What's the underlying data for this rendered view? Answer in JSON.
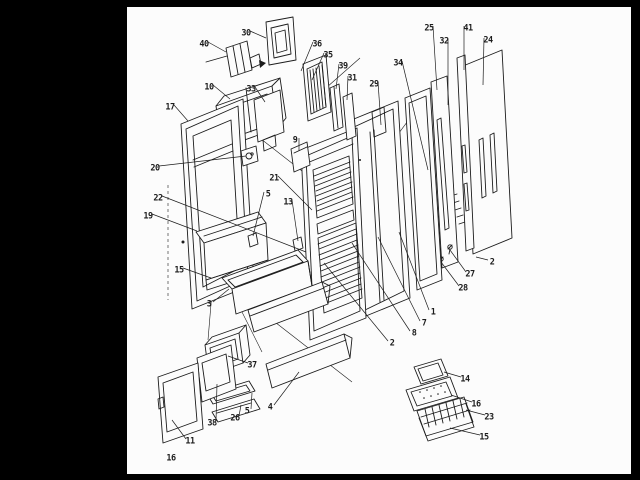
{
  "page": {
    "number": "16"
  },
  "colors": {
    "ink": "#1c1c1c",
    "paper": "#fcfcfc",
    "border": "#000000"
  },
  "figure": {
    "description": "Exploded parts diagram of a refrigerator door assembly",
    "callouts": [
      {
        "label": "40",
        "x": 204,
        "y": 44,
        "tx": 226,
        "ty": 52
      },
      {
        "label": "30",
        "x": 246,
        "y": 33,
        "tx": 266,
        "ty": 38
      },
      {
        "label": "36",
        "x": 317,
        "y": 44,
        "tx": 301,
        "ty": 71
      },
      {
        "label": "35",
        "x": 328,
        "y": 55,
        "tx": 312,
        "ty": 80
      },
      {
        "label": "39",
        "x": 343,
        "y": 66,
        "tx": 336,
        "ty": 89
      },
      {
        "label": "31",
        "x": 352,
        "y": 78,
        "tx": 347,
        "ty": 100
      },
      {
        "label": "34",
        "x": 398,
        "y": 63,
        "tx": 428,
        "ty": 170
      },
      {
        "label": "29",
        "x": 374,
        "y": 84,
        "tx": 381,
        "ty": 125
      },
      {
        "label": "25",
        "x": 429,
        "y": 28,
        "tx": 437,
        "ty": 90
      },
      {
        "label": "32",
        "x": 444,
        "y": 41,
        "tx": 448,
        "ty": 105
      },
      {
        "label": "41",
        "x": 468,
        "y": 28,
        "tx": 464,
        "ty": 70
      },
      {
        "label": "24",
        "x": 488,
        "y": 40,
        "tx": 483,
        "ty": 85
      },
      {
        "label": "10",
        "x": 209,
        "y": 87,
        "tx": 230,
        "ty": 99
      },
      {
        "label": "33",
        "x": 251,
        "y": 89,
        "tx": 265,
        "ty": 102
      },
      {
        "label": "17",
        "x": 170,
        "y": 107,
        "tx": 188,
        "ty": 121
      },
      {
        "label": "9",
        "x": 295,
        "y": 140,
        "tx": 299,
        "ty": 151
      },
      {
        "label": "20",
        "x": 155,
        "y": 168,
        "tx": 246,
        "ty": 156
      },
      {
        "label": "21",
        "x": 274,
        "y": 178,
        "tx": 312,
        "ty": 210
      },
      {
        "label": "22",
        "x": 158,
        "y": 198,
        "tx": 306,
        "ty": 252
      },
      {
        "label": "5",
        "x": 268,
        "y": 194,
        "tx": 253,
        "ty": 236
      },
      {
        "label": "13",
        "x": 288,
        "y": 202,
        "tx": 298,
        "ty": 241
      },
      {
        "label": "19",
        "x": 148,
        "y": 216,
        "tx": 197,
        "ty": 231
      },
      {
        "label": "15",
        "x": 179,
        "y": 270,
        "tx": 211,
        "ty": 278
      },
      {
        "label": "3",
        "x": 209,
        "y": 304,
        "tx": 229,
        "ty": 289
      },
      {
        "label": "37",
        "x": 252,
        "y": 365,
        "tx": 228,
        "ty": 356
      },
      {
        "label": "2",
        "x": 392,
        "y": 343,
        "tx": 324,
        "ty": 263
      },
      {
        "label": "8",
        "x": 414,
        "y": 333,
        "tx": 352,
        "ty": 243
      },
      {
        "label": "7",
        "x": 424,
        "y": 323,
        "tx": 378,
        "ty": 237
      },
      {
        "label": "1",
        "x": 433,
        "y": 312,
        "tx": 399,
        "ty": 232
      },
      {
        "label": "27",
        "x": 470,
        "y": 274,
        "tx": 450,
        "ty": 250
      },
      {
        "label": "28",
        "x": 463,
        "y": 288,
        "tx": 441,
        "ty": 262
      },
      {
        "label": "2",
        "x": 492,
        "y": 262,
        "tx": 476,
        "ty": 257
      },
      {
        "label": "4",
        "x": 270,
        "y": 407,
        "tx": 299,
        "ty": 372
      },
      {
        "label": "5",
        "x": 247,
        "y": 411,
        "tx": 252,
        "ty": 393
      },
      {
        "label": "26",
        "x": 235,
        "y": 418,
        "tx": 241,
        "ty": 405
      },
      {
        "label": "38",
        "x": 212,
        "y": 423,
        "tx": 217,
        "ty": 384
      },
      {
        "label": "11",
        "x": 190,
        "y": 441,
        "tx": 172,
        "ty": 420
      },
      {
        "label": "14",
        "x": 465,
        "y": 379,
        "tx": 444,
        "ty": 372
      },
      {
        "label": "16",
        "x": 476,
        "y": 404,
        "tx": 451,
        "ty": 395
      },
      {
        "label": "23",
        "x": 489,
        "y": 417,
        "tx": 466,
        "ty": 410
      },
      {
        "label": "15",
        "x": 484,
        "y": 437,
        "tx": 450,
        "ty": 428
      }
    ]
  }
}
